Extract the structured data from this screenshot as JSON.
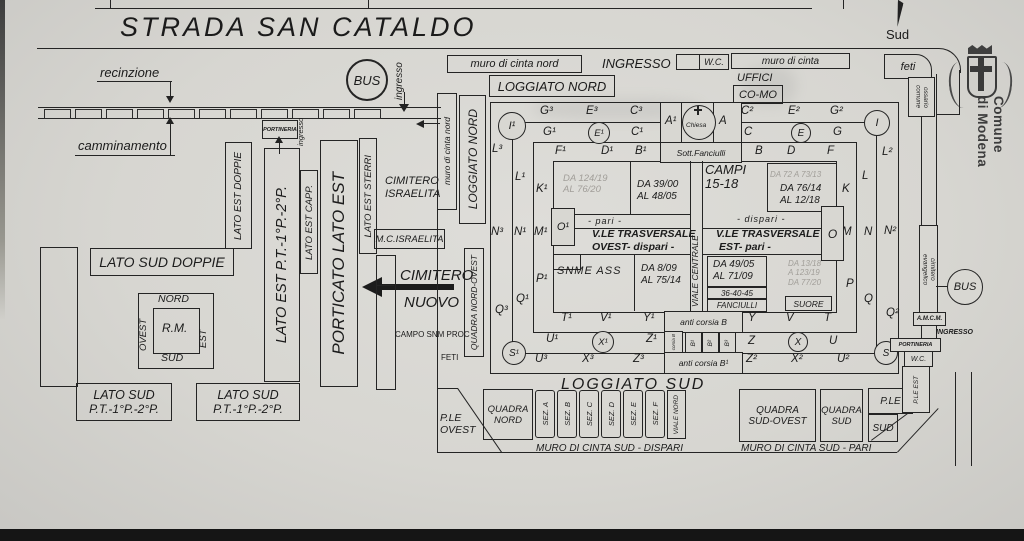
{
  "page": {
    "street_name": "STRADA SAN CATALDO",
    "compass_south": "Sud"
  },
  "logo": {
    "line1": "Comune",
    "line2": "di Modena"
  },
  "street": {
    "recinzione": "recinzione",
    "camminamento": "camminamento",
    "bus": "BUS",
    "ingresso": "ingresso"
  },
  "west": {
    "lato_sud_doppie": "LATO SUD DOPPIE",
    "lato_est_doppie": "LATO EST DOPPIE",
    "lato_est_pt": "LATO EST P.T.-1°P.-2°P.",
    "lato_est_capp": "LATO EST CAPP.",
    "porticato_lato_est": "PORTICATO LATO EST",
    "lato_est_sterri": "LATO EST STERRI",
    "portineria": "PORTINERIA",
    "ingresso": "ingresso",
    "rm": {
      "nord": "NORD",
      "ovest": "OVEST",
      "center": "R.M.",
      "est": "EST",
      "sud": "SUD"
    },
    "lato_sud_1": {
      "line1": "LATO SUD",
      "line2": "P.T.-1°P.-2°P."
    },
    "lato_sud_2": {
      "line1": "LATO SUD",
      "line2": "P.T.-1°P.-2°P."
    },
    "israelita": {
      "line1": "CIMITERO",
      "line2": "ISRAELITA",
      "mc": "M.C.ISRAELITA"
    },
    "nuovo": {
      "line1": "CIMITERO",
      "line2": "NUOVO"
    },
    "campo_snm": {
      "line1": "CAMPO SNM PROC",
      "line2": "FETI"
    },
    "quadra_nord_ovest": "QUADRA NORD-OVEST"
  },
  "north": {
    "muro_cinta_nord_v": "muro di cinta nord",
    "loggiato_nord_v": "LOGGIATO NORD",
    "muro_cinta_nord": "muro di cinta nord",
    "ingresso": "INGRESSO",
    "wc": "W.C.",
    "muro_cinta": "muro di cinta",
    "feti": "feti",
    "ossario": {
      "line1": "ossario",
      "line2": "comune"
    },
    "loggiato_nord": "LOGGIATO NORD",
    "uffici": "UFFICI",
    "como": "CO-MO"
  },
  "complex": {
    "i1": "I¹",
    "i": "I",
    "s1": "S¹",
    "s": "S",
    "g3": "G³",
    "e3": "E³",
    "c3": "C³",
    "g1": "G¹",
    "e1": "E¹",
    "c1": "C¹",
    "f1": "F¹",
    "d1": "D¹",
    "b1": "B¹",
    "a1": "A¹",
    "chiesa": "Chiesa",
    "a": "A",
    "c2": "C²",
    "e2": "E²",
    "g2": "G²",
    "c": "C",
    "e": "E",
    "g": "G",
    "b": "B",
    "d": "D",
    "f": "F",
    "sott_fanciulli": "Sott.Fanciulli",
    "l3": "L³",
    "l1": "L¹",
    "k1": "K¹",
    "n3": "N³",
    "n1": "N¹",
    "m1": "M¹",
    "o1": "O¹",
    "p1": "P¹",
    "q1": "Q¹",
    "q3": "Q³",
    "t1": "T¹",
    "v1": "V¹",
    "y1": "Y¹",
    "u1": "U¹",
    "x1": "X¹",
    "z1": "Z¹",
    "u3": "U³",
    "x3": "X³",
    "z3": "Z³",
    "l2": "L²",
    "l": "L",
    "k": "K",
    "o": "O",
    "m": "M",
    "n": "N",
    "n2": "N²",
    "p": "P",
    "q": "Q",
    "q2": "Q²",
    "y": "Y",
    "v": "V",
    "t": "T",
    "z": "Z",
    "x": "X",
    "u": "U",
    "z2": "Z²",
    "x2": "X²",
    "u2": "U²",
    "viale_centrale": "VIALE CENTRALE",
    "fields": {
      "da124": "DA 124/19",
      "al76": "AL 76/20",
      "da39": "DA 39/00",
      "al48": "AL 48/05",
      "pari": "-  pari  -",
      "vle_trasversale_w": "V.LE TRASVERSALE",
      "ovest_dispari": "OVEST-  dispari  -",
      "snme": "SNME ASS",
      "da8": "DA 8/09",
      "al75": "AL 75/14",
      "campi": "CAMPI",
      "campi_n": "15-18",
      "da72": "DA 72 A 73/13",
      "da76": "DA 76/14",
      "al12": "AL 12/18",
      "dispari": "-  dispari  -",
      "vle_trasversale_e": "V.LE TRASVERSALE",
      "est_pari": "EST-  pari  -",
      "da49": "DA 49/05",
      "al71": "AL 71/09",
      "da13": "DA 13/18",
      "a123": "A 123/19",
      "da77": "DA 77/20",
      "nums": "36-40-45",
      "fanciulli": "FANCIULLI",
      "suore": "SUORE"
    },
    "corsie": {
      "anti_b": "anti corsia B",
      "corsia_b": "corsia B",
      "b1": "B¹",
      "b2": "B²",
      "b3": "B³",
      "anti_b1": "anti corsia B¹"
    }
  },
  "east": {
    "evangelico": {
      "line1": "cimitero",
      "line2": "evangelico"
    },
    "amcm": "A.M.C.M.",
    "bus": "BUS",
    "ingresso": "INGRESSO",
    "portineria": "PORTINERIA",
    "wc": "W.C.",
    "ple_est": "P.LE EST"
  },
  "south": {
    "loggiato_sud": "LOGGIATO SUD",
    "quadra_nord": {
      "line1": "QUADRA",
      "line2": "NORD"
    },
    "sez": [
      "SEZ. A",
      "SEZ. B",
      "SEZ. C",
      "SEZ. D",
      "SEZ. E",
      "SEZ. F"
    ],
    "viale_nord": "VIALE NORD",
    "ple_ovest": {
      "line1": "P.LE",
      "line2": "OVEST"
    },
    "muro_dispari": "MURO DI CINTA SUD  -  DISPARI",
    "quadra_sud_ovest": {
      "line1": "QUADRA",
      "line2": "SUD-OVEST"
    },
    "quadra_sud": {
      "line1": "QUADRA",
      "line2": "SUD"
    },
    "ple": "P.LE",
    "sud": "SUD",
    "muro_pari": "MURO DI CINTA SUD  -  PARI"
  },
  "colors": {
    "paper": "#d8d7d2",
    "ink": "#242424",
    "faint": "#a19e99"
  }
}
